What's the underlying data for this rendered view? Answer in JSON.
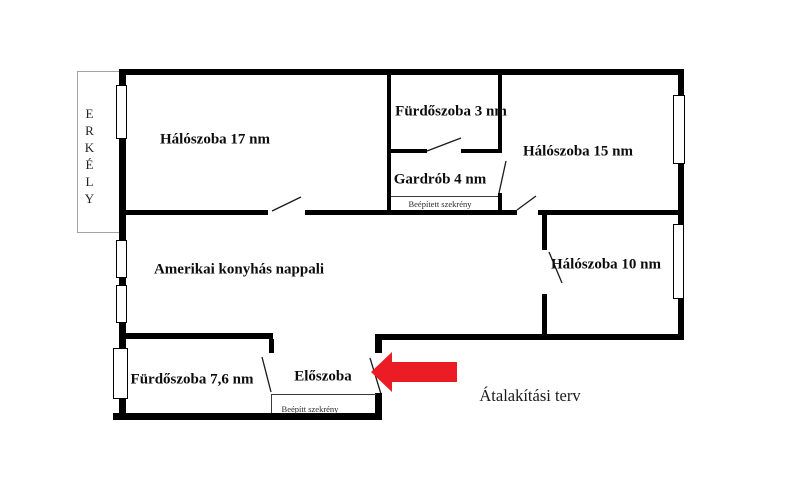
{
  "plan": {
    "balcony": {
      "label": "ERKÉLY"
    },
    "rooms": [
      {
        "name": "bedroom-17",
        "label": "Hálószoba 17 nm"
      },
      {
        "name": "bathroom-3",
        "label": "Fürdőszoba 3 nm"
      },
      {
        "name": "bedroom-15",
        "label": "Hálószoba 15 nm"
      },
      {
        "name": "wardrobe-4",
        "label": "Gardrób 4 nm"
      },
      {
        "name": "bedroom-10",
        "label": "Hálószoba 10 nm"
      },
      {
        "name": "living-kitchen",
        "label": "Amerikai konyhás nappali"
      },
      {
        "name": "bathroom-7-6",
        "label": "Fürdőszoba 7,6 nm"
      },
      {
        "name": "hallway",
        "label": "Előszoba"
      }
    ],
    "builtin_wardrobes": [
      {
        "label": "Beépített szekrény"
      },
      {
        "label": "Beépítt szekrény"
      }
    ],
    "title": "Átalakítási terv",
    "arrow": {
      "color": "#ec1c24",
      "direction": "left"
    }
  }
}
